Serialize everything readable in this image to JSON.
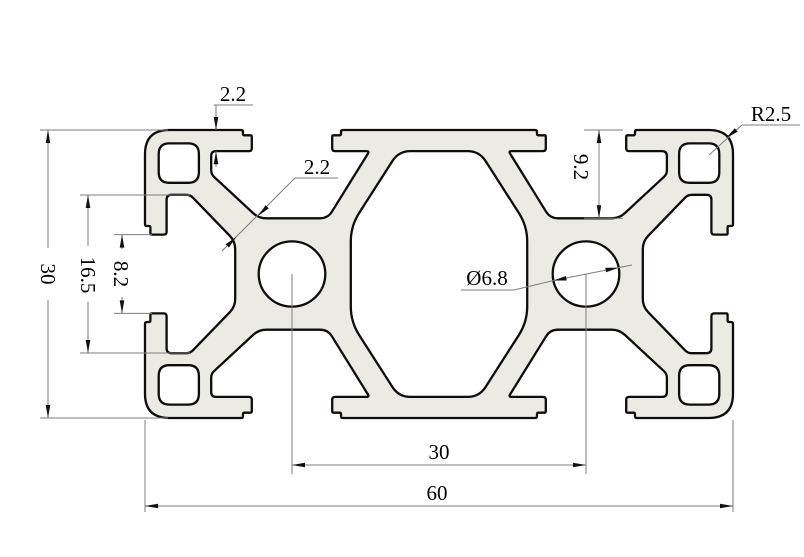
{
  "drawing": {
    "type": "technical-cad-cross-section",
    "subject": "30x60 aluminum T-slot extrusion profile, 2D section with dimensions",
    "colors": {
      "background": "#ffffff",
      "profile_fill": "#ebebe4",
      "outline": "#0d0d0d",
      "dimension_lines": "#7d7d7d",
      "text": "#000000"
    },
    "dimensions": {
      "overall_height": "30",
      "overall_width": "60",
      "channel_width": "16.5",
      "slot_opening": "8.2",
      "slot_depth": "9.2",
      "top_wall": "2.2",
      "web_wall": "2.2",
      "corner_radius": "R2.5",
      "hole_diameter": "Ø6.8",
      "hole_spacing": "30"
    }
  }
}
